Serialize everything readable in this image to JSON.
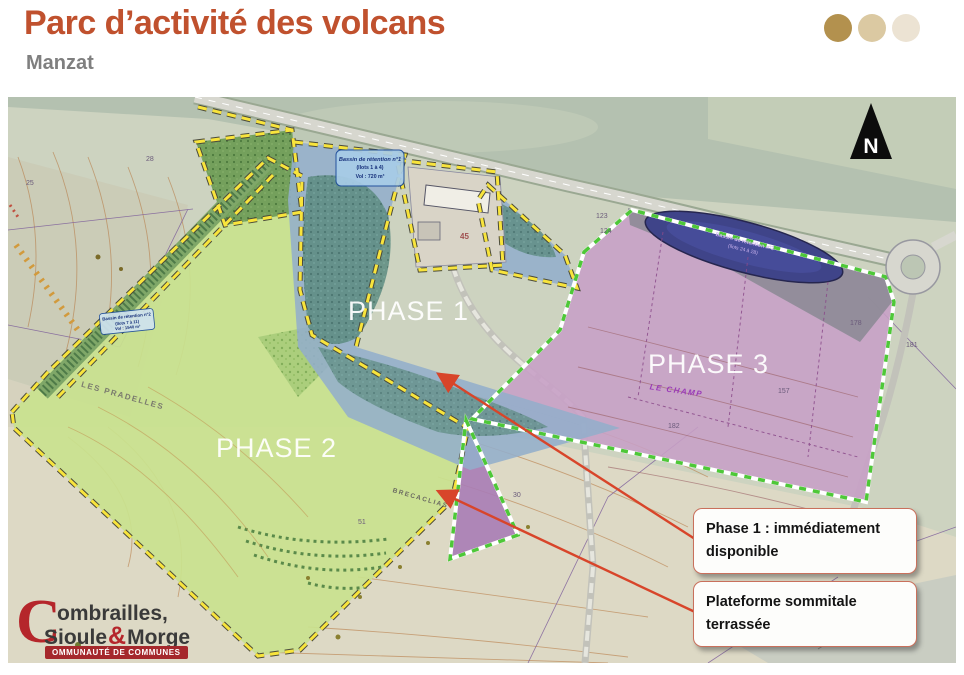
{
  "header": {
    "title": "Parc d’activité des volcans",
    "subtitle": "Manzat"
  },
  "decor": {
    "dot_colors": [
      "#B3914E",
      "#DBC9A2",
      "#ECE3D3"
    ]
  },
  "map": {
    "compass": "N",
    "phase_labels": {
      "phase1": "PHASE 1",
      "phase2": "PHASE 2",
      "phase3": "PHASE 3"
    },
    "place_names": {
      "les_pradelles": "LES PRADELLES",
      "le_champ": "LE CHAMP",
      "brecaclias": "BRECACLIAS"
    },
    "basins": {
      "b1": {
        "l1": "Bassin de rétention n°1",
        "l2": "(îlots 1 à 4)",
        "l3": "Vol : 720 m³"
      },
      "b2": {
        "l1": "Bassin de rétention n°2",
        "l2": "(îlots 7 à 11)",
        "l3": "Vol : 1540 m³"
      },
      "b3": {
        "l1": "Bassin de rétention n°3",
        "l2": "(îlots 24 à 28)"
      }
    },
    "building_number": "45",
    "parcels": {
      "p25": "25",
      "p28": "28",
      "p123": "123",
      "p124": "124",
      "p178": "178",
      "p181": "181",
      "p157": "157",
      "p182": "182",
      "p30": "30",
      "p51": "51"
    }
  },
  "callouts": {
    "phase1_available": "Phase 1 : immédiatement disponible",
    "platform": "Plateforme sommitale terrassée"
  },
  "logo": {
    "initial": "C",
    "word1": "ombrailles,",
    "word2a": "Sioule",
    "amp": "&",
    "word2b": "Morge",
    "banner": "OMMUNAUTÉ DE COMMUNES"
  },
  "colors": {
    "title": "#C0512E",
    "subtitle": "#7F7F7F",
    "arrow": "#D8452A",
    "phase1_fill": "#93AECB",
    "phase2_fill": "#C9E28E",
    "phase3_fill": "#C79FC6",
    "border_yellow": "#F8E43C",
    "border_green": "#4EC838",
    "callout_border": "#C9705C",
    "logo_red": "#B5262B"
  }
}
